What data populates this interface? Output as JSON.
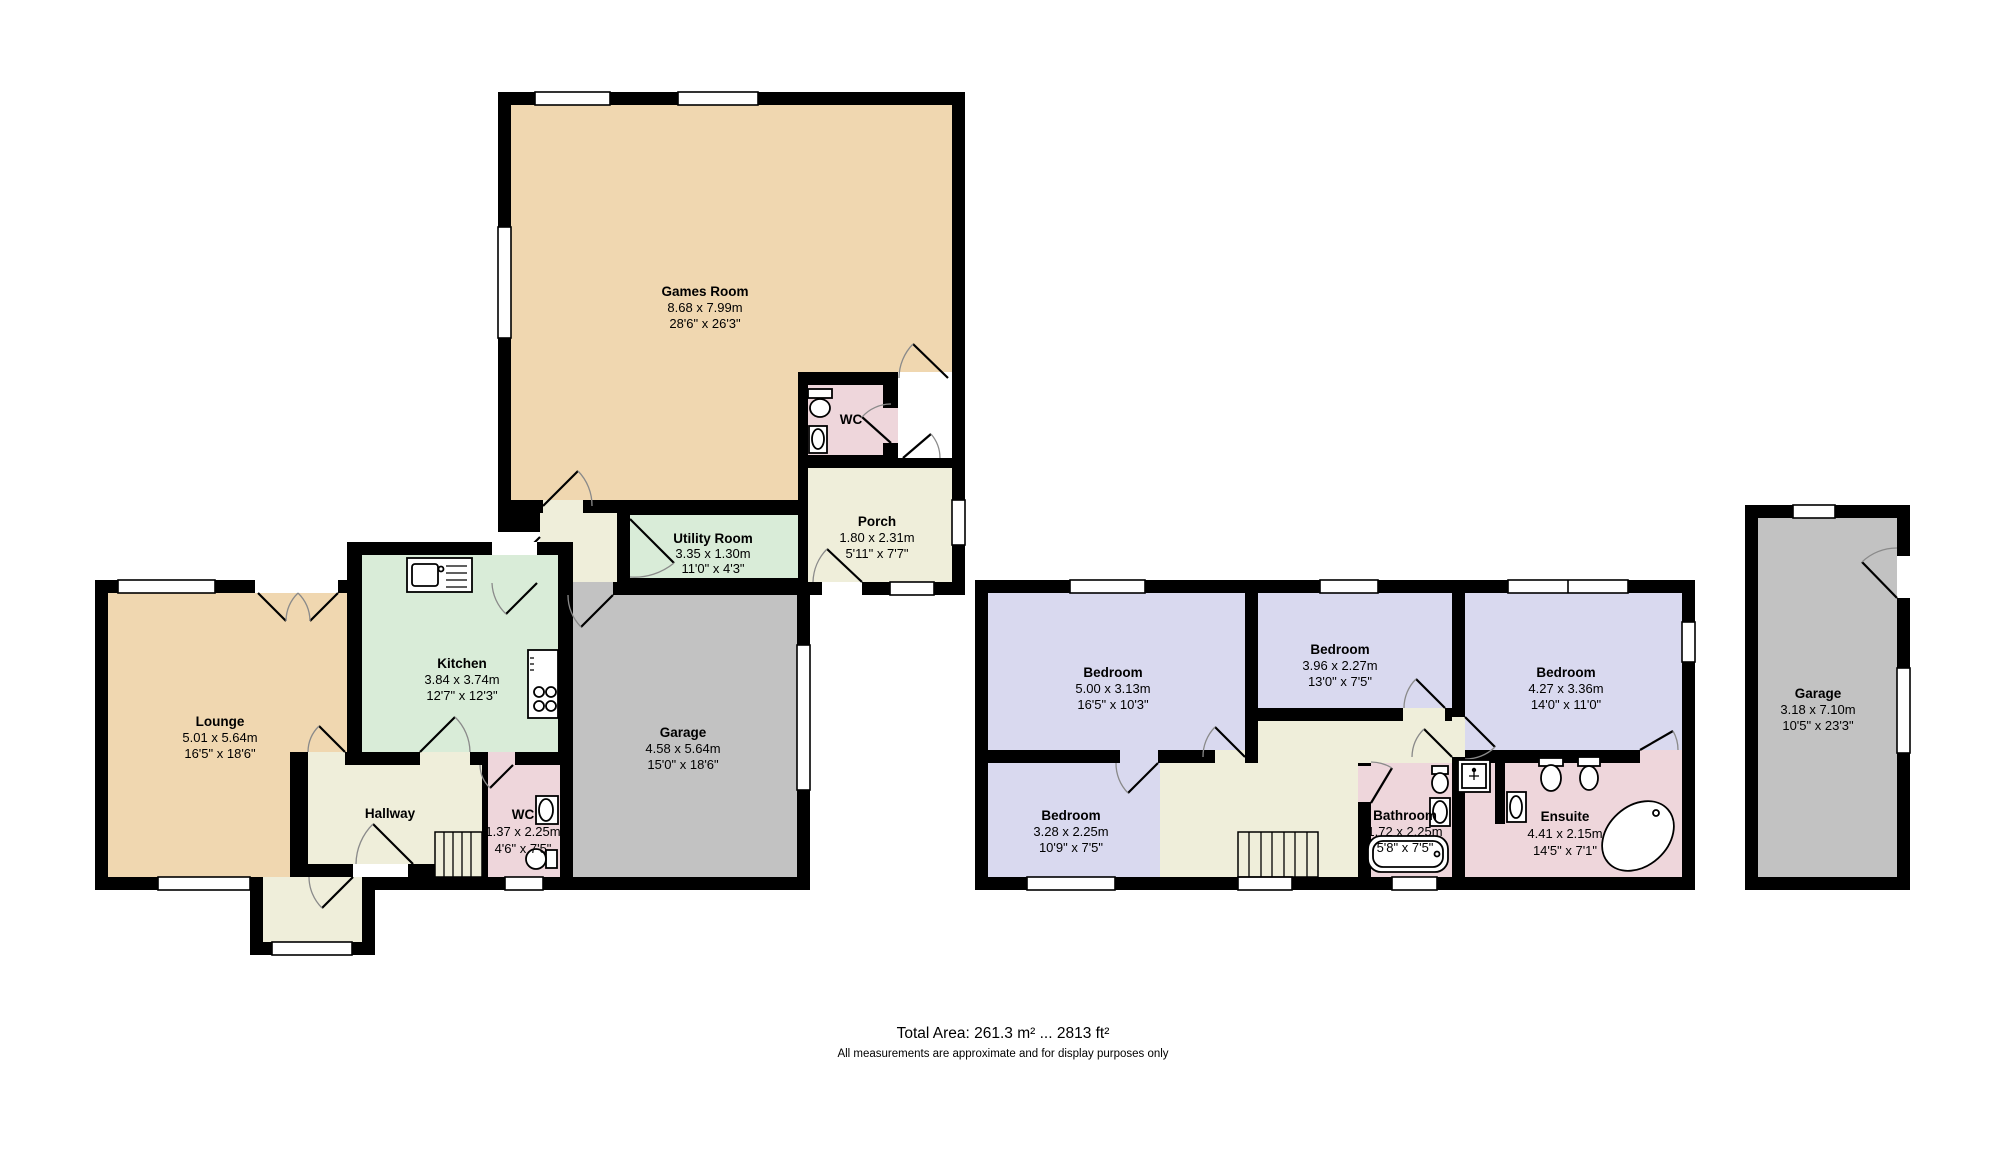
{
  "footer": {
    "total_area": "Total Area: 261.3 m² ... 2813 ft²",
    "note": "All measurements are approximate and for display purposes only"
  },
  "colors": {
    "wall": "#000000",
    "room_tan": "#f0d7b0",
    "room_green": "#d9ecd8",
    "room_lavender": "#d9d9ef",
    "room_pink": "#eed6db",
    "room_cream": "#efeeda",
    "room_gray": "#c2c2c2",
    "background": "#ffffff"
  },
  "rooms": {
    "games_room": {
      "name": "Games Room",
      "metric": "8.68 x 7.99m",
      "imperial": "28'6\" x 26'3\""
    },
    "wc_annex": {
      "name": "WC"
    },
    "porch": {
      "name": "Porch",
      "metric": "1.80 x 2.31m",
      "imperial": "5'11\" x 7'7\""
    },
    "utility": {
      "name": "Utility Room",
      "metric": "3.35 x 1.30m",
      "imperial": "11'0\" x 4'3\""
    },
    "kitchen": {
      "name": "Kitchen",
      "metric": "3.84 x 3.74m",
      "imperial": "12'7\" x 12'3\""
    },
    "lounge": {
      "name": "Lounge",
      "metric": "5.01 x 5.64m",
      "imperial": "16'5\" x 18'6\""
    },
    "hallway": {
      "name": "Hallway"
    },
    "wc_ground": {
      "name": "WC",
      "metric": "1.37 x 2.25m",
      "imperial": "4'6\" x 7'5\""
    },
    "garage_attached": {
      "name": "Garage",
      "metric": "4.58 x 5.64m",
      "imperial": "15'0\" x 18'6\""
    },
    "bedroom_1": {
      "name": "Bedroom",
      "metric": "5.00 x 3.13m",
      "imperial": "16'5\" x 10'3\""
    },
    "bedroom_2": {
      "name": "Bedroom",
      "metric": "3.96 x 2.27m",
      "imperial": "13'0\" x 7'5\""
    },
    "bedroom_3": {
      "name": "Bedroom",
      "metric": "4.27 x 3.36m",
      "imperial": "14'0\" x 11'0\""
    },
    "bedroom_4": {
      "name": "Bedroom",
      "metric": "3.28 x 2.25m",
      "imperial": "10'9\" x 7'5\""
    },
    "bathroom": {
      "name": "Bathroom",
      "metric": "1.72 x 2.25m",
      "imperial": "5'8\" x 7'5\""
    },
    "ensuite": {
      "name": "Ensuite",
      "metric": "4.41 x 2.15m",
      "imperial": "14'5\" x 7'1\""
    },
    "garage_detached": {
      "name": "Garage",
      "metric": "3.18 x 7.10m",
      "imperial": "10'5\" x 23'3\""
    }
  }
}
